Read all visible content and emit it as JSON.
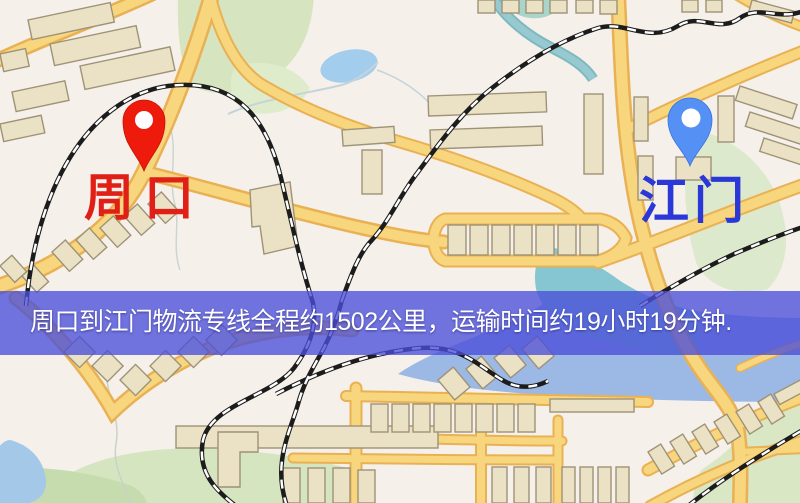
{
  "map": {
    "origin": {
      "name": "周口",
      "label_color": "#e02017",
      "pin_color": "#ee1a0c",
      "pin_inner_color": "#ffffff"
    },
    "destination": {
      "name": "江门",
      "label_color": "#2b38d8",
      "pin_color": "#5590f4",
      "pin_inner_color": "#ffffff"
    },
    "banner": {
      "text": "周口到江门物流专线全程约1502公里，运输时间约19小时19分钟.",
      "overlay_color": "#4a4ed9",
      "text_color": "#ffffff",
      "distance_km": "1502",
      "duration": "19小时19分钟"
    }
  }
}
